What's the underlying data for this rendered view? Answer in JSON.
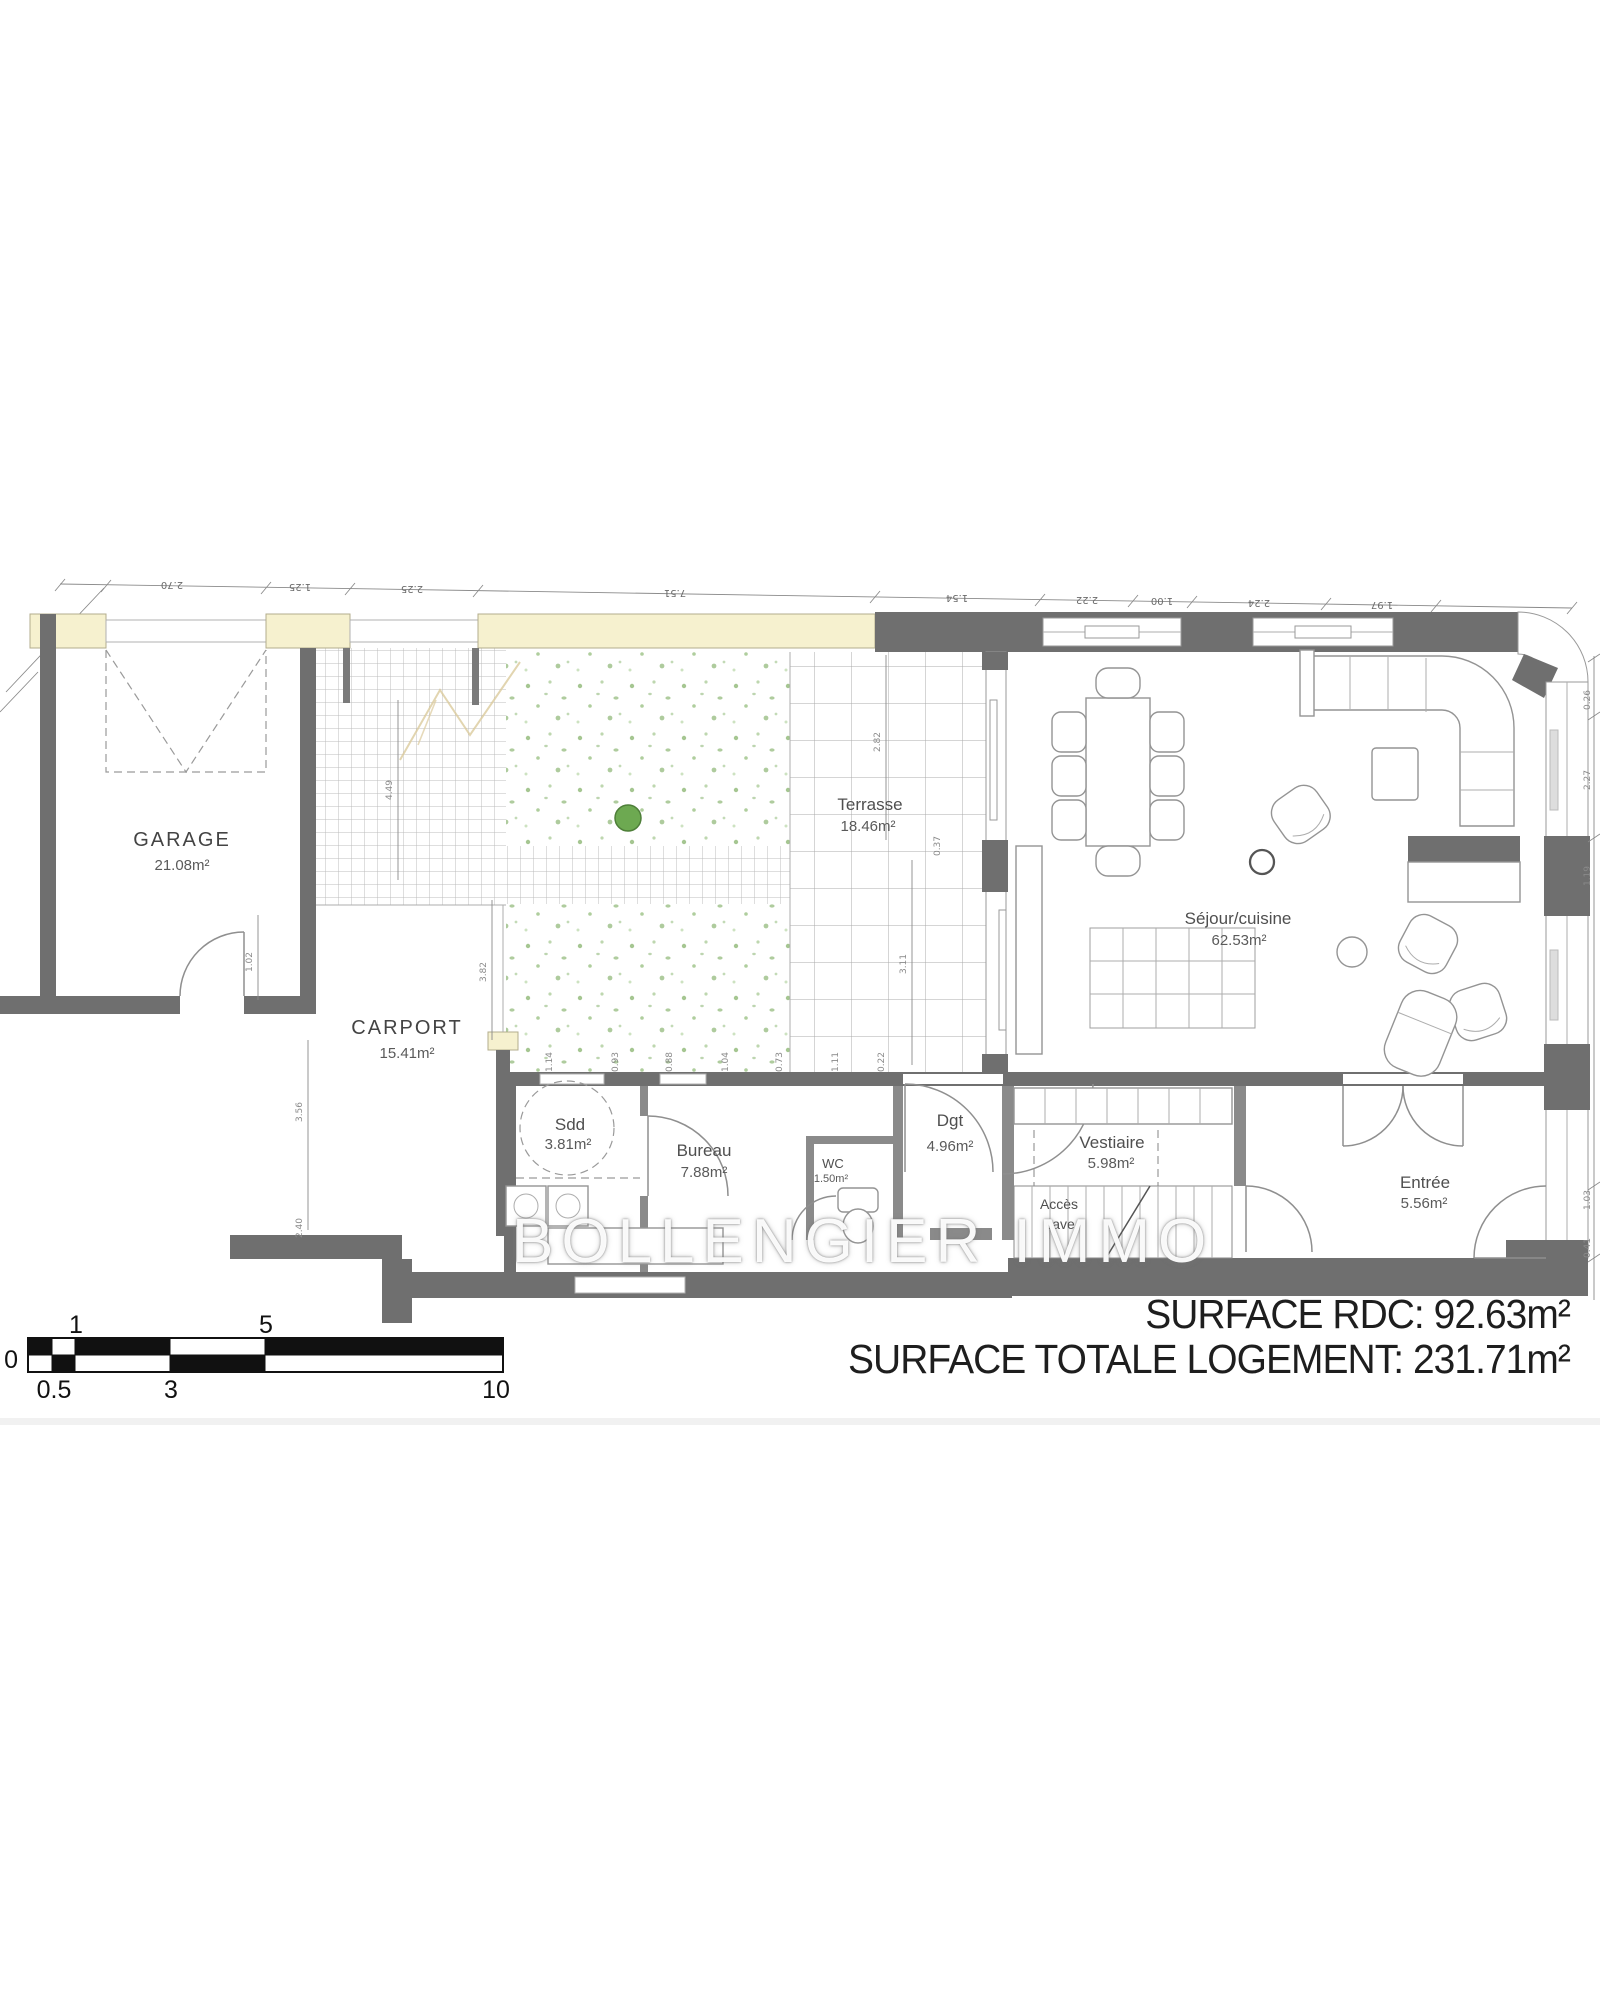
{
  "rooms": {
    "garage": {
      "name": "GARAGE",
      "area": "21.08m²"
    },
    "carport": {
      "name": "CARPORT",
      "area": "15.41m²"
    },
    "terrasse": {
      "name": "Terrasse",
      "area": "18.46m²"
    },
    "sejour": {
      "name": "Séjour/cuisine",
      "area": "62.53m²"
    },
    "sdd": {
      "name": "Sdd",
      "area": "3.81m²"
    },
    "bureau": {
      "name": "Bureau",
      "area": "7.88m²"
    },
    "wc": {
      "name": "WC",
      "area": "1.50m²"
    },
    "dgt": {
      "name": "Dgt",
      "area": "4.96m²"
    },
    "vestiaire": {
      "name": "Vestiaire",
      "area": "5.98m²"
    },
    "acces_cave": {
      "line1": "Accès",
      "line2": "cave"
    },
    "entree": {
      "name": "Entrée",
      "area": "5.56m²"
    }
  },
  "summary": {
    "line1": "SURFACE RDC: 92.63m²",
    "line2": "SURFACE TOTALE LOGEMENT: 231.71m²"
  },
  "watermark": "BOLLENGIER IMMO",
  "dimensions": {
    "top": [
      "2.70",
      "1.25",
      "2.25",
      "7.51",
      "1.54",
      "2.22",
      "1.00",
      "2.24",
      "1.97"
    ],
    "left": [
      "4.49",
      "1.02",
      "3.82",
      "3.56",
      "2.40"
    ],
    "right": [
      "0.26",
      "2.27",
      "1.19",
      "1.03",
      "0.41"
    ],
    "inner": [
      "2.82",
      "0.37",
      "3.11"
    ],
    "bottom_row": [
      "1.14",
      "0.93",
      "0.88",
      "1.04",
      "0.73",
      "1.11",
      "0.22"
    ]
  },
  "scalebar": {
    "zero": "0",
    "above": [
      "1",
      "5"
    ],
    "below": [
      "0.5",
      "3",
      "10"
    ]
  },
  "colors": {
    "wall": "#6f6f6f",
    "cream": "#f6f1cf",
    "tree_green": "#6da951",
    "grid": "#b5b5b5",
    "background": "#ffffff",
    "divider": "#f1f1f1"
  }
}
